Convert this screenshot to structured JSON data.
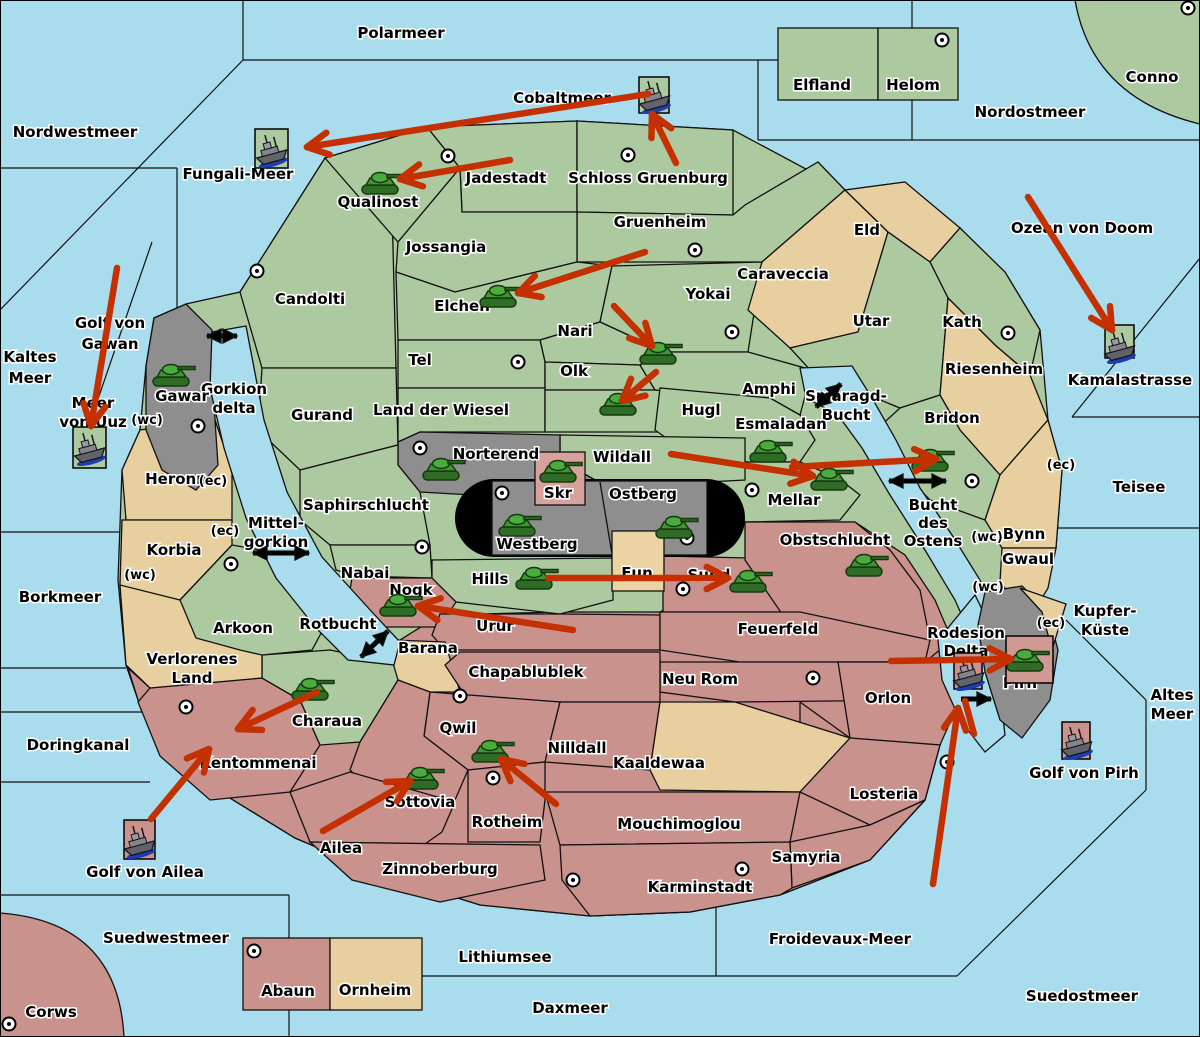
{
  "map": {
    "width": 1200,
    "height": 1037,
    "colors": {
      "sea": "#a9dcec",
      "green": "#adc9a0",
      "tan": "#e8cfa0",
      "pink": "#c9928c",
      "gray": "#8e8e8e",
      "box_pink": "#d7a29b",
      "box_tan": "#ecd3a4",
      "arrow_red": "#c43000",
      "arrow_yellow": "#ffe54a",
      "arrow_black": "#000000",
      "tank_green": "#3f9434",
      "explosion_orange": "#ff8c00"
    }
  },
  "labels": [
    {
      "t": "Polarmeer",
      "x": 401,
      "y": 38
    },
    {
      "t": "Nordwestmeer",
      "x": 75,
      "y": 137
    },
    {
      "t": "Cobaltmeer",
      "x": 562,
      "y": 103
    },
    {
      "t": "Nordostmeer",
      "x": 1030,
      "y": 117
    },
    {
      "t": "Conno",
      "x": 1152,
      "y": 82
    },
    {
      "t": "Ozean von Doom",
      "x": 1082,
      "y": 233
    },
    {
      "t": "Kaltes\nMeer",
      "x": 30,
      "y": 362,
      "dy": 21
    },
    {
      "t": "Golf von\nGawan",
      "x": 110,
      "y": 328,
      "dy": 21
    },
    {
      "t": "Meer\nvon Uuz",
      "x": 93,
      "y": 408,
      "dy": 19
    },
    {
      "t": "Fungali-Meer",
      "x": 238,
      "y": 179
    },
    {
      "t": "Kamalastrasse",
      "x": 1130,
      "y": 385
    },
    {
      "t": "Teisee",
      "x": 1139,
      "y": 492
    },
    {
      "t": "Kupfer-\nKüste",
      "x": 1105,
      "y": 616,
      "dy": 19
    },
    {
      "t": "Altes\nMeer",
      "x": 1172,
      "y": 700,
      "dy": 19
    },
    {
      "t": "Golf von Pirh",
      "x": 1084,
      "y": 778
    },
    {
      "t": "Borkmeer",
      "x": 60,
      "y": 602
    },
    {
      "t": "Doringkanal",
      "x": 78,
      "y": 750
    },
    {
      "t": "Golf von Ailea",
      "x": 145,
      "y": 877
    },
    {
      "t": "Suedwestmeer",
      "x": 166,
      "y": 943
    },
    {
      "t": "Corws",
      "x": 51,
      "y": 1017
    },
    {
      "t": "Lithiumsee",
      "x": 505,
      "y": 962
    },
    {
      "t": "Daxmeer",
      "x": 570,
      "y": 1013
    },
    {
      "t": "Froidevaux-Meer",
      "x": 840,
      "y": 944
    },
    {
      "t": "Suedostmeer",
      "x": 1082,
      "y": 1001
    },
    {
      "t": "Gorkion\ndelta",
      "x": 234,
      "y": 394,
      "dy": 19
    },
    {
      "t": "Smaragd-\nBucht",
      "x": 846,
      "y": 401,
      "dy": 19
    },
    {
      "t": "Bucht\ndes\nOstens",
      "x": 933,
      "y": 510,
      "dy": 18
    },
    {
      "t": "Mittel-\ngorkion",
      "x": 276,
      "y": 528,
      "dy": 19
    },
    {
      "t": "Rotbucht",
      "x": 338,
      "y": 629
    },
    {
      "t": "Elfland",
      "x": 822,
      "y": 90
    },
    {
      "t": "Helom",
      "x": 913,
      "y": 90
    },
    {
      "t": "Jadestadt",
      "x": 506,
      "y": 183
    },
    {
      "t": "Schloss Gruenburg",
      "x": 648,
      "y": 183
    },
    {
      "t": "Qualinost",
      "x": 378,
      "y": 207
    },
    {
      "t": "Jossangia",
      "x": 446,
      "y": 252
    },
    {
      "t": "Gruenheim",
      "x": 660,
      "y": 227
    },
    {
      "t": "Candolti",
      "x": 310,
      "y": 304
    },
    {
      "t": "Elchen",
      "x": 462,
      "y": 311
    },
    {
      "t": "Nari",
      "x": 575,
      "y": 336
    },
    {
      "t": "Yokai",
      "x": 708,
      "y": 299
    },
    {
      "t": "Tel",
      "x": 420,
      "y": 365
    },
    {
      "t": "Olk",
      "x": 574,
      "y": 376
    },
    {
      "t": "Gurand",
      "x": 322,
      "y": 420
    },
    {
      "t": "Land der Wiesel",
      "x": 441,
      "y": 415
    },
    {
      "t": "Hugl",
      "x": 701,
      "y": 415
    },
    {
      "t": "Amphi",
      "x": 769,
      "y": 394
    },
    {
      "t": "Utar",
      "x": 871,
      "y": 326
    },
    {
      "t": "Kath",
      "x": 962,
      "y": 327
    },
    {
      "t": "Eld",
      "x": 867,
      "y": 235
    },
    {
      "t": "Caraveccia",
      "x": 783,
      "y": 279
    },
    {
      "t": "Riesenheim",
      "x": 994,
      "y": 374
    },
    {
      "t": "Bridon",
      "x": 952,
      "y": 423
    },
    {
      "t": "Esmaladan",
      "x": 781,
      "y": 429
    },
    {
      "t": "Norterend",
      "x": 496,
      "y": 459
    },
    {
      "t": "Wildall",
      "x": 622,
      "y": 462
    },
    {
      "t": "Mellar",
      "x": 794,
      "y": 505
    },
    {
      "t": "Saphirschlucht",
      "x": 366,
      "y": 510
    },
    {
      "t": "Skr",
      "x": 558,
      "y": 498
    },
    {
      "t": "Ostberg",
      "x": 643,
      "y": 499
    },
    {
      "t": "Westberg",
      "x": 537,
      "y": 549
    },
    {
      "t": "Obstschlucht",
      "x": 835,
      "y": 545
    },
    {
      "t": "Heronn",
      "x": 176,
      "y": 484
    },
    {
      "t": "Korbia",
      "x": 174,
      "y": 555
    },
    {
      "t": "Arkoon",
      "x": 243,
      "y": 633
    },
    {
      "t": "Nabai",
      "x": 365,
      "y": 578
    },
    {
      "t": "Hills",
      "x": 490,
      "y": 584
    },
    {
      "t": "Eun",
      "x": 637,
      "y": 578
    },
    {
      "t": "Sund",
      "x": 709,
      "y": 580
    },
    {
      "t": "Nogk",
      "x": 411,
      "y": 595
    },
    {
      "t": "Urur",
      "x": 495,
      "y": 631
    },
    {
      "t": "Barana",
      "x": 428,
      "y": 653
    },
    {
      "t": "Feuerfeld",
      "x": 778,
      "y": 634
    },
    {
      "t": "Verlorenes\nLand",
      "x": 192,
      "y": 664,
      "dy": 19
    },
    {
      "t": "Charaua",
      "x": 327,
      "y": 726
    },
    {
      "t": "Chapablublek",
      "x": 526,
      "y": 677
    },
    {
      "t": "Neu Rom",
      "x": 700,
      "y": 684
    },
    {
      "t": "Rodesion\nDelta",
      "x": 966,
      "y": 638,
      "dy": 18
    },
    {
      "t": "Pirh",
      "x": 1020,
      "y": 688
    },
    {
      "t": "Orlon",
      "x": 888,
      "y": 703
    },
    {
      "t": "Kentommenai",
      "x": 258,
      "y": 768
    },
    {
      "t": "Qwil",
      "x": 458,
      "y": 733
    },
    {
      "t": "Nilldall",
      "x": 577,
      "y": 753
    },
    {
      "t": "Kaaldewaa",
      "x": 659,
      "y": 768
    },
    {
      "t": "Sottovia",
      "x": 420,
      "y": 807
    },
    {
      "t": "Rotheim",
      "x": 507,
      "y": 827
    },
    {
      "t": "Mouchimoglou",
      "x": 679,
      "y": 829
    },
    {
      "t": "Losteria",
      "x": 884,
      "y": 799
    },
    {
      "t": "Ailea",
      "x": 341,
      "y": 853
    },
    {
      "t": "Zinnoberburg",
      "x": 440,
      "y": 874
    },
    {
      "t": "Samyria",
      "x": 806,
      "y": 862
    },
    {
      "t": "Karminstadt",
      "x": 700,
      "y": 892
    },
    {
      "t": "Abaun",
      "x": 288,
      "y": 996
    },
    {
      "t": "Ornheim",
      "x": 375,
      "y": 995
    },
    {
      "t": "Gawar",
      "x": 182,
      "y": 401
    },
    {
      "t": "Bynn",
      "x": 1024,
      "y": 539
    },
    {
      "t": "Gwaul",
      "x": 1028,
      "y": 564
    },
    {
      "t": "(wc)",
      "x": 147,
      "y": 424,
      "s": 13
    },
    {
      "t": "(ec)",
      "x": 213,
      "y": 485,
      "s": 13
    },
    {
      "t": "(ec)",
      "x": 225,
      "y": 535,
      "s": 13
    },
    {
      "t": "(wc)",
      "x": 140,
      "y": 579,
      "s": 13
    },
    {
      "t": "(ec)",
      "x": 1061,
      "y": 469,
      "s": 13
    },
    {
      "t": "(wc)",
      "x": 987,
      "y": 541,
      "s": 13
    },
    {
      "t": "(wc)",
      "x": 988,
      "y": 591,
      "s": 13
    },
    {
      "t": "(ec)",
      "x": 1051,
      "y": 627,
      "s": 13
    }
  ],
  "city_markers": [
    [
      448,
      156
    ],
    [
      628,
      155
    ],
    [
      942,
      40
    ],
    [
      1188,
      8
    ],
    [
      257,
      271
    ],
    [
      695,
      250
    ],
    [
      732,
      332
    ],
    [
      518,
      362
    ],
    [
      1008,
      333
    ],
    [
      972,
      481
    ],
    [
      198,
      426
    ],
    [
      231,
      564
    ],
    [
      420,
      448
    ],
    [
      502,
      493
    ],
    [
      687,
      538
    ],
    [
      752,
      490
    ],
    [
      422,
      547
    ],
    [
      683,
      589
    ],
    [
      186,
      707
    ],
    [
      460,
      696
    ],
    [
      493,
      778
    ],
    [
      813,
      678
    ],
    [
      947,
      762
    ],
    [
      573,
      880
    ],
    [
      742,
      869
    ],
    [
      254,
      951
    ],
    [
      9,
      1024
    ]
  ],
  "units": {
    "tanks": [
      [
        382,
        182
      ],
      [
        500,
        295
      ],
      [
        660,
        352
      ],
      [
        620,
        403
      ],
      [
        173,
        374
      ],
      [
        443,
        468
      ],
      [
        560,
        470
      ],
      [
        519,
        524
      ],
      [
        676,
        526
      ],
      [
        770,
        450
      ],
      [
        831,
        478
      ],
      [
        932,
        459
      ],
      [
        866,
        564
      ],
      [
        536,
        577
      ],
      [
        750,
        580
      ],
      [
        400,
        604
      ],
      [
        312,
        688
      ],
      [
        422,
        777
      ],
      [
        492,
        750
      ],
      [
        1027,
        659
      ]
    ],
    "ships": [
      {
        "x": 271,
        "y": 150,
        "box": [
          255,
          129,
          33,
          39,
          "green"
        ]
      },
      {
        "x": 654,
        "y": 96,
        "box": [
          639,
          77,
          30,
          36,
          "green"
        ]
      },
      {
        "x": 89,
        "y": 448,
        "box": [
          73,
          427,
          33,
          41,
          "green"
        ]
      },
      {
        "x": 1119,
        "y": 346,
        "box": [
          1105,
          325,
          29,
          33,
          "green"
        ]
      },
      {
        "x": 968,
        "y": 673,
        "box": [
          954,
          653,
          28,
          36,
          "pink"
        ]
      },
      {
        "x": 1076,
        "y": 742,
        "box": [
          1062,
          722,
          28,
          37,
          "pink"
        ]
      },
      {
        "x": 139,
        "y": 841,
        "box": [
          124,
          820,
          31,
          39,
          "pink"
        ]
      }
    ],
    "boxed_tank_box": [
      1006,
      636,
      47,
      47
    ]
  },
  "arrows": {
    "red": [
      [
        648,
        94,
        307,
        147,
        1
      ],
      [
        676,
        163,
        652,
        114,
        1
      ],
      [
        510,
        160,
        400,
        179,
        1
      ],
      [
        645,
        252,
        518,
        293,
        1
      ],
      [
        614,
        306,
        652,
        346,
        1
      ],
      [
        656,
        372,
        622,
        401,
        1
      ],
      [
        671,
        454,
        813,
        476,
        1
      ],
      [
        792,
        467,
        936,
        459,
        1
      ],
      [
        548,
        578,
        728,
        578,
        1
      ],
      [
        573,
        630,
        418,
        606,
        1
      ],
      [
        317,
        692,
        238,
        729,
        1
      ],
      [
        151,
        819,
        209,
        749,
        1
      ],
      [
        323,
        831,
        410,
        781,
        1
      ],
      [
        556,
        804,
        501,
        759,
        1
      ],
      [
        891,
        661,
        1011,
        659,
        1
      ],
      [
        933,
        884,
        958,
        708,
        1
      ],
      [
        974,
        734,
        965,
        701,
        0
      ],
      [
        1028,
        197,
        1112,
        330,
        1
      ],
      [
        117,
        268,
        91,
        426,
        1
      ]
    ],
    "yellow": [
      [
        1060,
        736,
        1013,
        668,
        1
      ],
      [
        1041,
        726,
        1018,
        697,
        0
      ],
      [
        787,
        427,
        764,
        456,
        1
      ],
      [
        773,
        436,
        779,
        466,
        0
      ]
    ]
  },
  "connections": [
    [
      207,
      336,
      237,
      336,
      2
    ],
    [
      253,
      553,
      309,
      553,
      2
    ],
    [
      361,
      657,
      388,
      631,
      2
    ],
    [
      816,
      407,
      841,
      384,
      2
    ],
    [
      889,
      481,
      946,
      481,
      2
    ],
    [
      961,
      699,
      991,
      699,
      1
    ]
  ],
  "crosses": [
    {
      "x": 605,
      "y": 577,
      "outlined": false
    },
    {
      "x": 273,
      "y": 704,
      "outlined": false
    },
    {
      "x": 165,
      "y": 801,
      "outlined": false
    },
    {
      "x": 222,
      "y": 735,
      "outlined": true
    }
  ],
  "explosions": [
    [
      1041,
      649
    ]
  ]
}
